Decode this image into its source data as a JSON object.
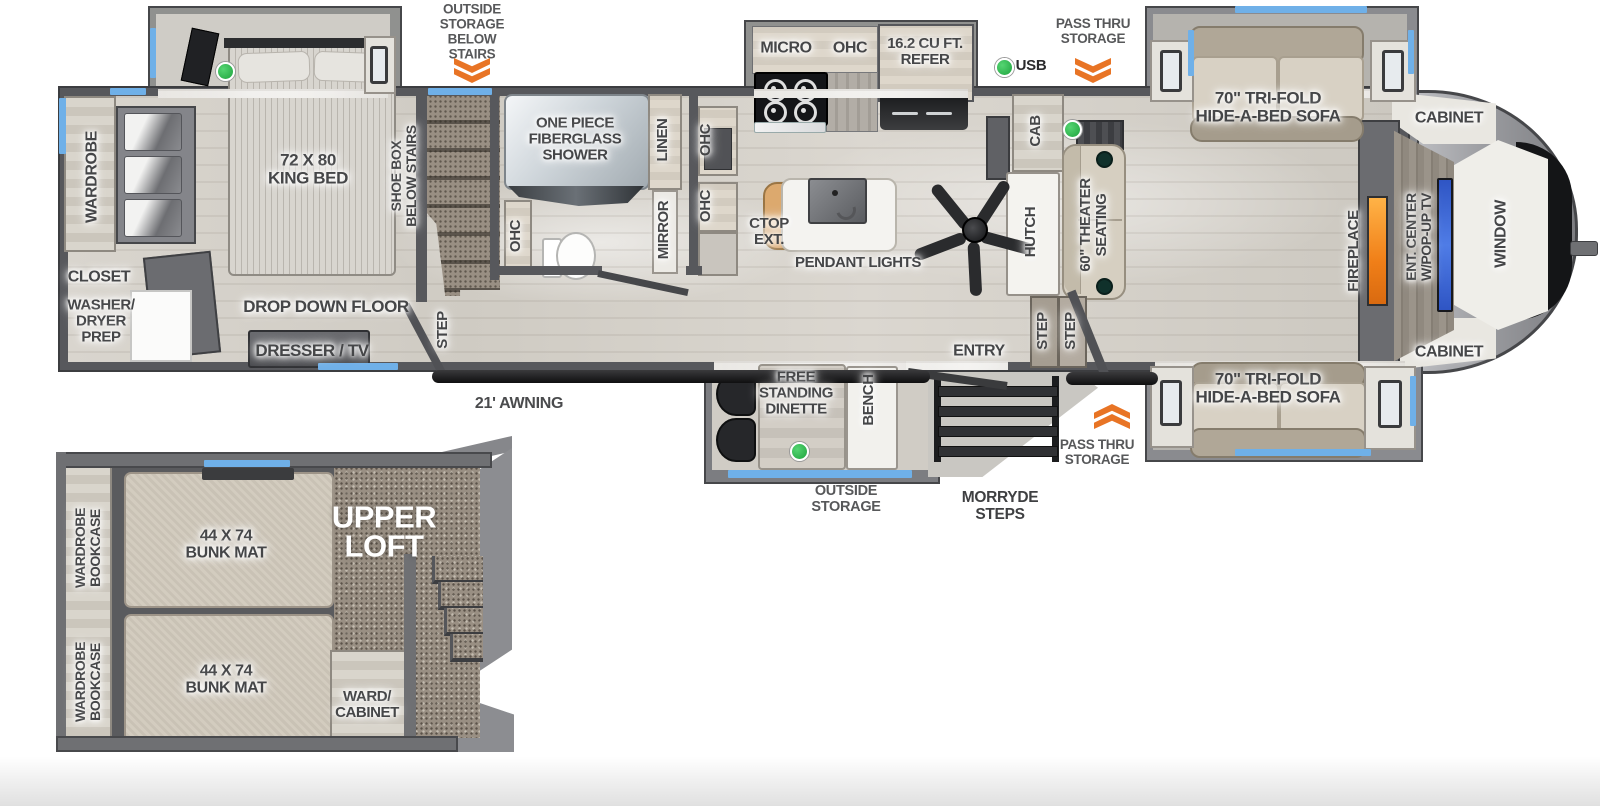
{
  "annotations": {
    "outside_storage_below_stairs": "OUTSIDE\nSTORAGE\nBELOW\nSTAIRS",
    "usb": "USB",
    "pass_thru_top": "PASS THRU\nSTORAGE",
    "pass_thru_bottom": "PASS THRU\nSTORAGE",
    "awning": "21' AWNING",
    "outside_storage": "OUTSIDE\nSTORAGE",
    "morryde_steps": "MORRYDE\nSTEPS"
  },
  "bedroom": {
    "wardrobe": "WARDROBE",
    "closet": "CLOSET",
    "washer_dryer_prep": "WASHER/\nDRYER\nPREP",
    "king_bed": "72 X 80\nKING BED",
    "shoe_box": "SHOE BOX\nBELOW STAIRS",
    "drop_down_floor": "DROP DOWN FLOOR",
    "dresser_tv": "DRESSER / TV",
    "step": "STEP"
  },
  "bathroom": {
    "shower": "ONE PIECE\nFIBERGLASS\nSHOWER",
    "linen": "LINEN",
    "mirror": "MIRROR",
    "ohc_left": "OHC"
  },
  "kitchen": {
    "micro": "MICRO",
    "ohc": "OHC",
    "refer": "16.2 CU FT.\nREFER",
    "ohc_wall_upper": "OHC",
    "ohc_wall_lower": "OHC",
    "ctop_ext": "CTOP\nEXT.",
    "pendant_lights": "PENDANT LIGHTS",
    "cab": "CAB"
  },
  "dinette": {
    "free_standing_dinette": "FREE\nSTANDING\nDINETTE",
    "bench": "BENCH"
  },
  "living": {
    "hutch": "HUTCH",
    "theater_seating": "60\" THEATER\nSEATING",
    "sofa_top": "70\" TRI-FOLD\nHIDE-A-BED SOFA",
    "sofa_bottom": "70\" TRI-FOLD\nHIDE-A-BED SOFA",
    "cabinet_top": "CABINET",
    "cabinet_bottom": "CABINET",
    "fireplace": "FIREPLACE",
    "ent_center": "ENT. CENTER\nW/POP-UP TV",
    "window": "WINDOW",
    "entry": "ENTRY",
    "step_1": "STEP",
    "step_2": "STEP"
  },
  "loft": {
    "title": "UPPER\nLOFT",
    "wardrobe_bookcase_1": "WARDROBE\nBOOKCASE",
    "wardrobe_bookcase_2": "WARDROBE\nBOOKCASE",
    "bunk_mat_1": "44 X 74\nBUNK MAT",
    "bunk_mat_2": "44 X 74\nBUNK MAT",
    "ward_cabinet": "WARD/\nCABINET"
  },
  "colors": {
    "accent_orange": "#e87425",
    "marker_green": "#2eb34a",
    "window_blue": "#6fb0e8",
    "fireplace_orange": "#f08c1e",
    "tv_blue": "#3a66d8",
    "wall_gray": "#57585c",
    "floor_wood": "#d7d3cc",
    "carpet": "#998f83"
  }
}
